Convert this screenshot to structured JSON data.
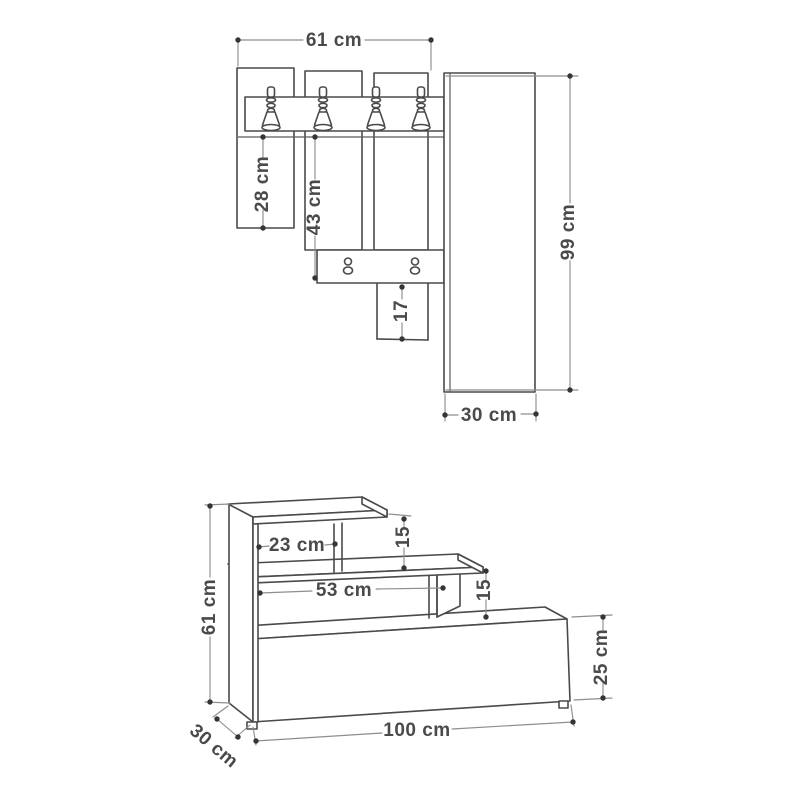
{
  "diagram": {
    "type": "furniture technical drawing with dimensions",
    "views": {
      "wall_unit": {
        "title": "wall panel with coat hooks - front view",
        "hooks": 4,
        "shelf_knobs": 2,
        "dimensions": {
          "total_width": "61 cm",
          "left_slat_length": "28 cm",
          "middle_slat_length": "43 cm",
          "bottom_slat_length": "17",
          "side_panel_height": "99 cm",
          "side_panel_width": "30 cm"
        }
      },
      "bench": {
        "title": "shoe bench - perspective view",
        "dimensions": {
          "top_shelf_width": "23 cm",
          "top_gap_height": "15",
          "middle_shelf_width": "53 cm",
          "middle_gap_height": "15",
          "total_height": "61 cm",
          "cabinet_front_height": "25 cm",
          "total_width": "100 cm",
          "depth": "30 cm"
        }
      }
    },
    "colors": {
      "background": "#ffffff",
      "structure_line": "#4a4a4a",
      "dimension_line": "#8e8e8e",
      "label_text": "#4a4a4a",
      "dot": "#353535"
    }
  }
}
